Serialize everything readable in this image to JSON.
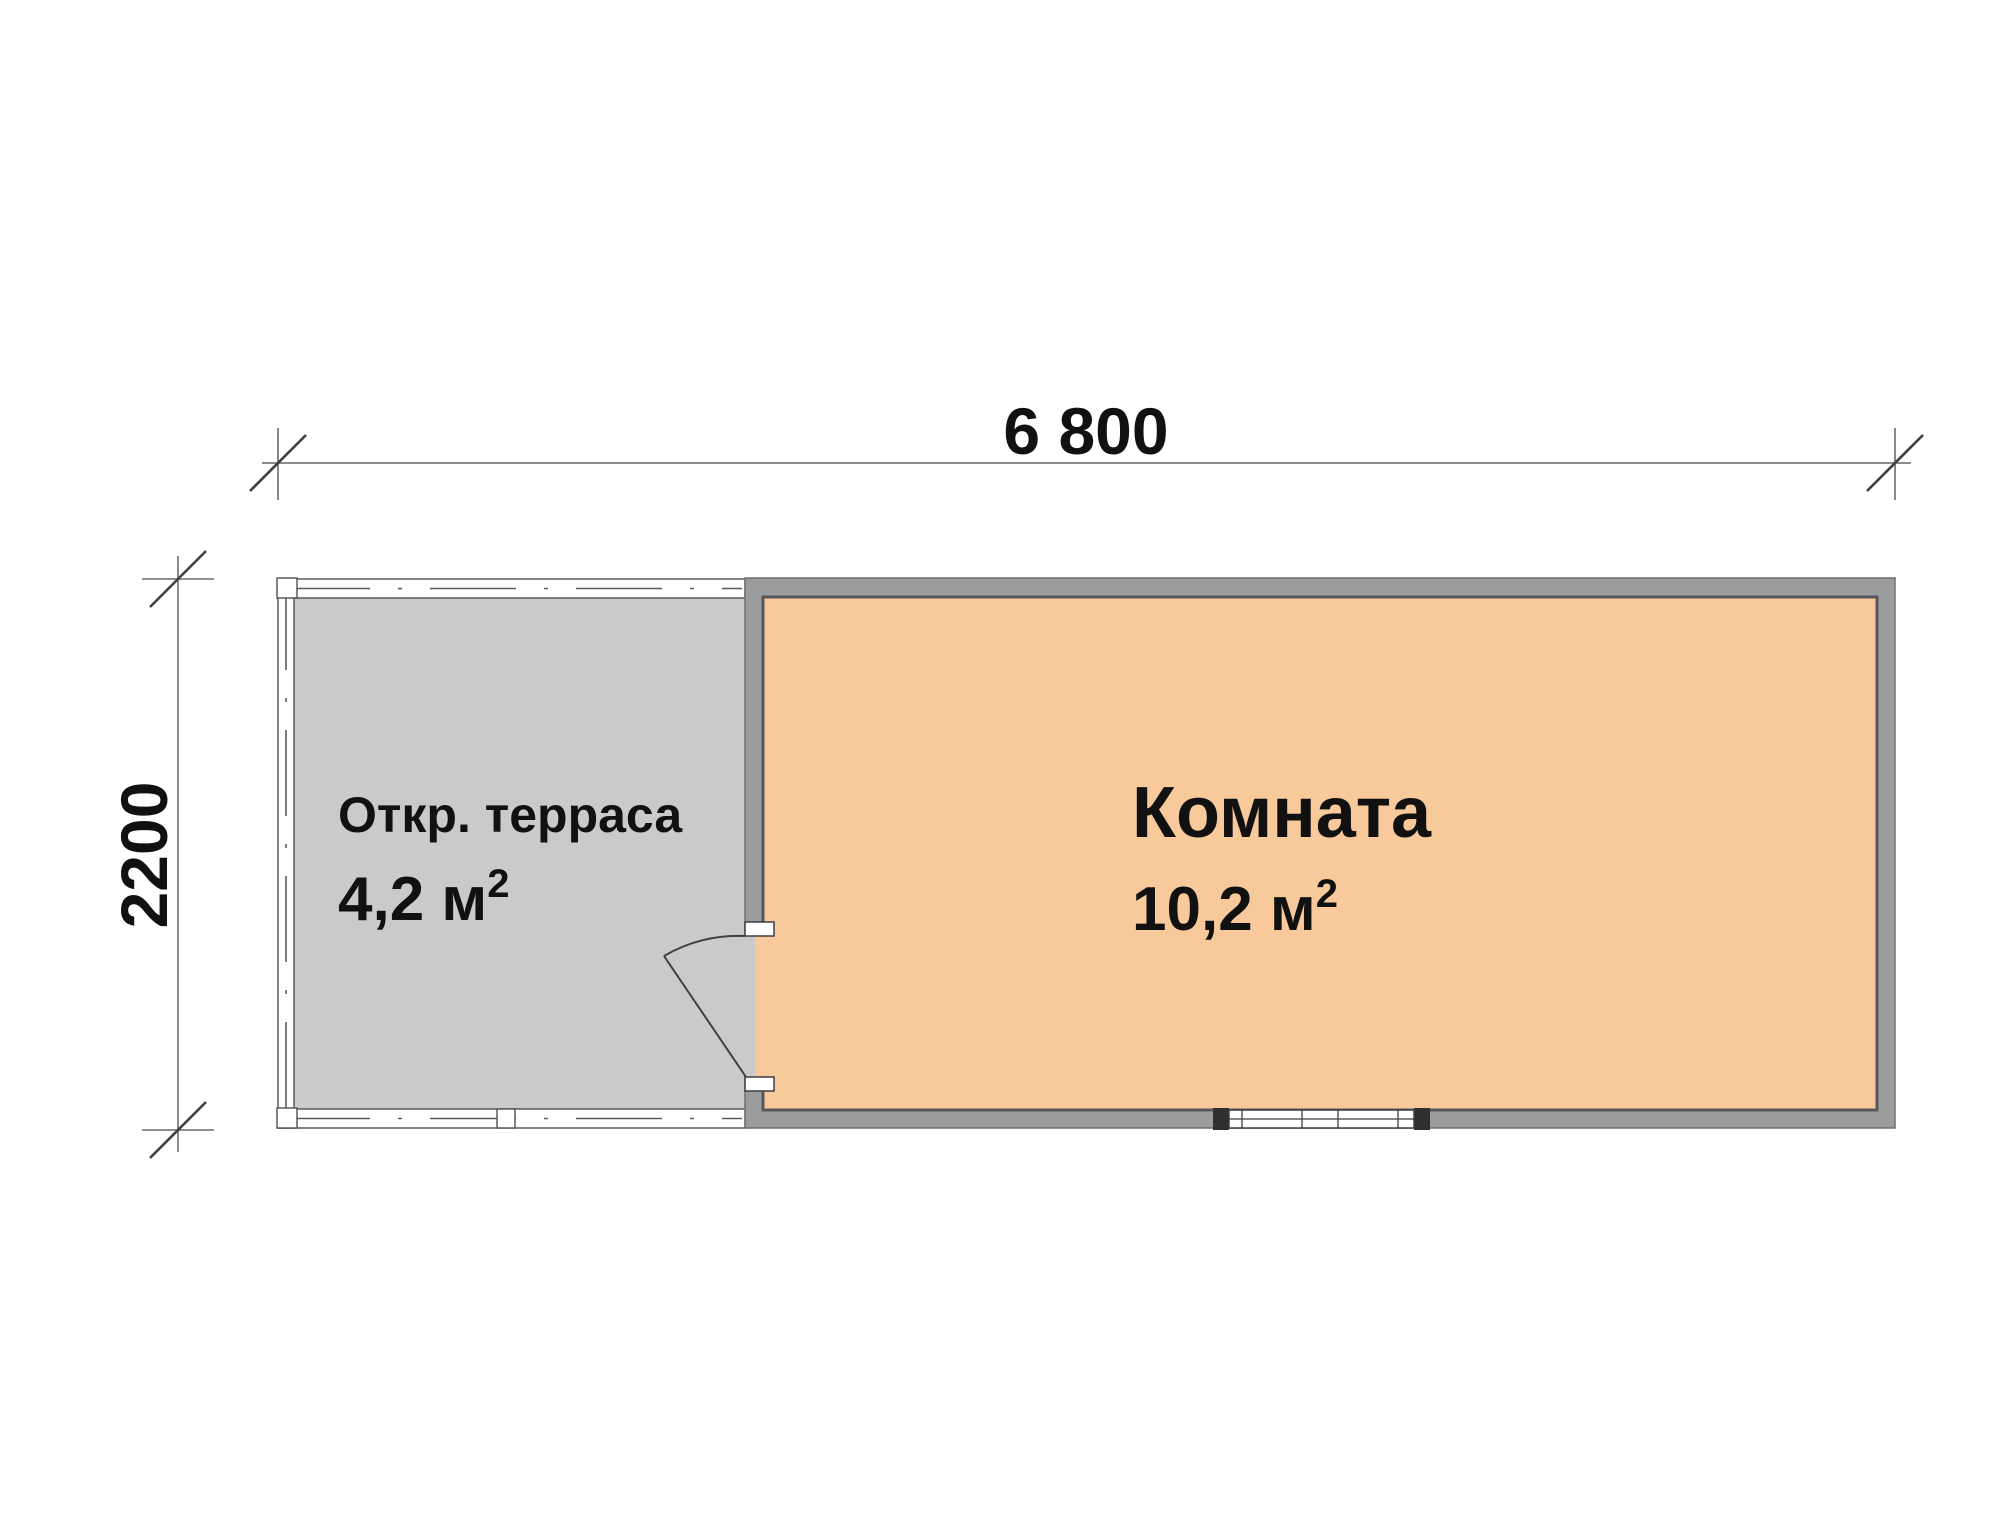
{
  "plan": {
    "top_dimension": {
      "label": "6 800"
    },
    "left_dimension": {
      "label": "2200"
    },
    "terrace": {
      "name": "Откр. терраса",
      "area": "4,2 м",
      "area_superscript": "2",
      "floor_color": "#CACACC"
    },
    "room": {
      "name": "Комната",
      "area": "10,2 м",
      "area_superscript": "2",
      "floor_color": "#F8C99A"
    },
    "colors": {
      "wall_fill": "#9B9C9E",
      "wall_inner_edge": "#57575A",
      "wall_outer_edge": "#6F6F71",
      "railing_outline": "#505052",
      "railing_dash": "#5B5B5D",
      "dimension_line": "#8C8C8E",
      "tick_slash": "#3F3F41",
      "window_frame": "#3F3F41",
      "label_text": "#111111"
    }
  }
}
